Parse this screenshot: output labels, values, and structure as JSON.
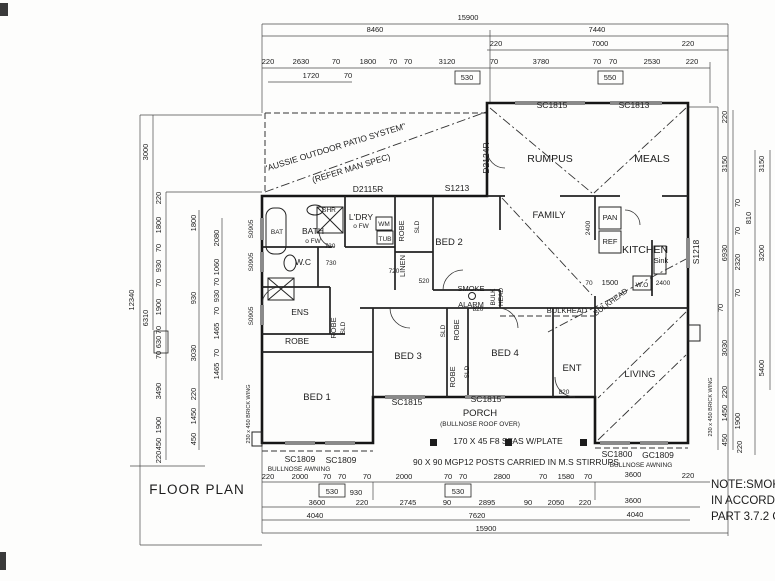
{
  "title": "FLOOR PLAN",
  "note": {
    "l1": "NOTE:SMOKE A",
    "l2": "IN ACCORDANC",
    "l3": "PART 3.7.2 OF"
  },
  "rooms": {
    "rumpus": "RUMPUS",
    "meals": "MEALS",
    "family": "FAMILY",
    "kitchen": "KITCHEN",
    "bed1": "BED 1",
    "bed2": "BED 2",
    "bed3": "BED 3",
    "bed4": "BED 4",
    "ent": "ENT",
    "living": "LIVING",
    "bath": "BATH",
    "wc": "W.C",
    "ens": "ENS",
    "ldry": "L'DRY",
    "linen": "LINEN",
    "robe_a": "ROBE",
    "robe_b": "ROBE",
    "robe_c": "ROBE",
    "robe_d": "ROBE",
    "robe_e": "ROBE",
    "porch": "PORCH"
  },
  "room_notes": {
    "bath_fw": "o FW",
    "ldry_fw": "o FW",
    "porch_roof": "(BULLNOSE ROOF OVER)"
  },
  "fixtures": {
    "bat": "BAT",
    "shr": "SHR",
    "wm": "WM",
    "tub": "TUB",
    "pan": "PAN",
    "ref": "REF",
    "sink": "Sink",
    "wo": "W.O",
    "sld_a": "SLD",
    "sld_b": "SLD",
    "sld_c": "SLD",
    "sld_d": "SLD"
  },
  "codes": {
    "d2115r": "D2115R",
    "s1213": "S1213",
    "d2124r": "D2124R",
    "sc1815_top": "SC1815",
    "sc1813_top": "SC1813",
    "s1218": "S1218",
    "s0905_a": "S0905",
    "s0905_b": "S0905",
    "s0905_c": "S0905",
    "sc1815_a": "SC1815",
    "sc1815_b": "SC1815",
    "sc1809_a": "SC1809",
    "sc1809_b": "SC1809",
    "sc1800": "SC1800",
    "gc1809": "GC1809"
  },
  "annotations": {
    "patio_1": "\"AUSSIE OUTDOOR PATIO SYSTEM\"",
    "patio_2": "(REFER MAN SPEC)",
    "smoke_1": "SMOKE",
    "smoke_2": "ALARM",
    "bulkhead_h": "BULKHEAD",
    "bulkhead_d": "BULKHEAD",
    "bulkhead_v1": "BULK",
    "bulkhead_v2": "HEAD",
    "plate": "170 X 45 F8 SFAS W/PLATE",
    "posts": "90 X 90 MGP12 POSTS CARRIED IN M.S STIRRUPS",
    "awning_l": "BULLNOSE AWNING",
    "awning_r": "BULLNOSE AWNING",
    "brick_l": "230 x 450 BRICK WING",
    "brick_r": "230 x 450 BRICK WING"
  },
  "dims": {
    "top_r1": [
      "15900"
    ],
    "top_r2": [
      "8460",
      "7440"
    ],
    "top_r3": [
      "220",
      "7000",
      "220"
    ],
    "top_r4": [
      "220",
      "2630",
      "70",
      "1800",
      "70",
      "70",
      "3120",
      "70",
      "3780",
      "70",
      "70",
      "2530",
      "220"
    ],
    "top_sub": [
      "1720",
      "70",
      "530",
      "550"
    ],
    "left_o": [
      "12340",
      "3000",
      "6310"
    ],
    "left_c1": [
      "220",
      "1800",
      "70",
      "930",
      "70",
      "1900",
      "70",
      "630",
      "70",
      "3490",
      "1900",
      "450",
      "220"
    ],
    "left_c2": [
      "1800",
      "930",
      "3030",
      "220",
      "1450",
      "450"
    ],
    "left_c3": [
      "2080",
      "1060",
      "70",
      "930",
      "70",
      "1465",
      "70",
      "1465"
    ],
    "right_c1": [
      "220",
      "3150",
      "6930",
      "3030",
      "220",
      "1450",
      "450"
    ],
    "right_c2": [
      "70",
      "810",
      "70",
      "2320",
      "70",
      "70",
      "1900",
      "220"
    ],
    "right_c3": [
      "3150",
      "3200",
      "5400"
    ],
    "bot_r1": [
      "220",
      "2000",
      "70",
      "70",
      "70",
      "2000",
      "70",
      "70",
      "2800",
      "70",
      "1580",
      "70",
      "3600",
      "220"
    ],
    "bot_sub": [
      "530",
      "930",
      "530"
    ],
    "bot_r2": [
      "3600",
      "220",
      "2745",
      "90",
      "2895",
      "90",
      "2050",
      "220",
      "3600"
    ],
    "bot_r3": [
      "4040",
      "7620",
      "4040"
    ],
    "bot_r4": [
      "15900"
    ],
    "inner": [
      "720",
      "730",
      "720",
      "520",
      "820",
      "820",
      "70",
      "1500",
      "2400",
      "2400"
    ]
  }
}
